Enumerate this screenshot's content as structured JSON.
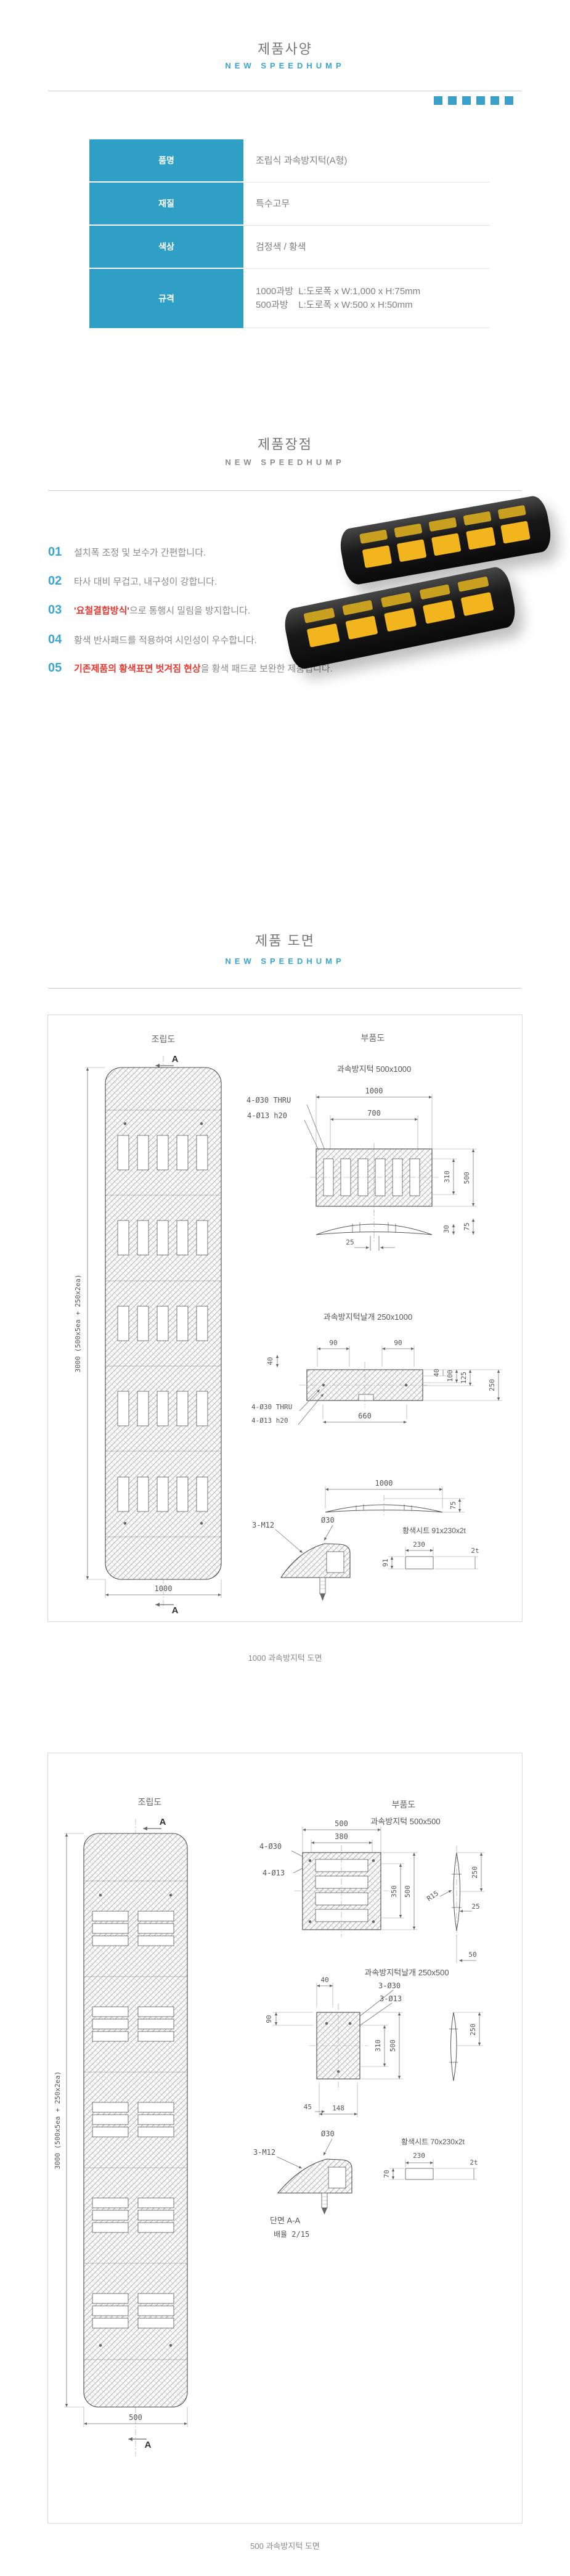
{
  "page": {
    "accent": "#3aa5d2",
    "table_header": "#2f9fc6",
    "red": "#e8372e",
    "pad_yellow": "#f2b51d"
  },
  "sections": {
    "spec": {
      "title": "제품사양",
      "subtitle": "NEW SPEEDHUMP"
    },
    "features": {
      "title": "제품장점",
      "subtitle": "NEW SPEEDHUMP"
    },
    "drawings": {
      "title": "제품 도면",
      "subtitle": "NEW SPEEDHUMP"
    }
  },
  "spec_table": {
    "rows": [
      {
        "label": "품명",
        "value": "조립식 과속방지턱(A형)"
      },
      {
        "label": "재질",
        "value": "특수고무"
      },
      {
        "label": "색상",
        "value": "검정색 / 황색"
      },
      {
        "label": "규격",
        "value_line1": "1000과방  L:도로폭 x W:1,000 x H:75mm",
        "value_line2": "500과방    L:도로폭 x W:500 x H:50mm"
      }
    ]
  },
  "features": {
    "items": [
      {
        "num": "01",
        "red": "",
        "text": "설치폭 조정 및 보수가 간편합니다."
      },
      {
        "num": "02",
        "red": "",
        "text": "타사 대비 무겁고, 내구성이 강합니다."
      },
      {
        "num": "03",
        "red": "'요철결합방식'",
        "text": "으로 통행시 밀림을 방지합니다."
      },
      {
        "num": "04",
        "red": "",
        "text": "황색 반사패드를 적용하여 시인성이 우수합니다."
      },
      {
        "num": "05",
        "red": "기존제품의 황색표면 벗겨짐 현상",
        "text": "을 황색 패드로 보완한 제품입니다."
      }
    ]
  },
  "drawing1": {
    "assembly": "조립도",
    "secA": "A",
    "secA2": "A",
    "left_dim": "3000 (500x5ea + 250x2ea)",
    "bottom_dim": "1000",
    "parts": "부품도",
    "part_title": "과속방지턱 500x1000",
    "d1000": "1000",
    "d700": "700",
    "h30": "4-Ø30 THRU",
    "h13": "4-Ø13 h20",
    "d310": "310",
    "d500": "500",
    "d25": "25",
    "d30": "30",
    "d75": "75",
    "wing_title": "과속방지턱날개 250x1000",
    "w90a": "90",
    "w90b": "90",
    "w40l": "40",
    "w40r": "40",
    "w100": "100",
    "w125": "125",
    "w250": "250",
    "w660": "660",
    "wh30": "4-Ø30 THRU",
    "wh13": "4-Ø13 h20",
    "p1000": "1000",
    "p75": "75",
    "o30": "Ø30",
    "m12": "3-M12",
    "sheet": "황색시트 91x230x2t",
    "s230": "230",
    "s91": "91",
    "s2t": "2t",
    "caption": "1000 과속방지턱 도면"
  },
  "drawing2": {
    "assembly": "조립도",
    "secA": "A",
    "secA2": "A",
    "left_dim": "3000 (500x5ea + 250x2ea)",
    "bottom_dim": "500",
    "parts": "부품도",
    "part_title": "과속방지턱 500x500",
    "d500": "500",
    "d380": "380",
    "h30": "4-Ø30",
    "h13": "4-Ø13",
    "d350": "350",
    "d500b": "500",
    "d250": "250",
    "r15": "R15",
    "d25": "25",
    "d50": "50",
    "wing_title": "과속방지턱날개 250x500",
    "w40": "40",
    "wh30": "3-Ø30",
    "wh13": "3-Ø13",
    "w90": "90",
    "w310": "310",
    "w500": "500",
    "w250": "250",
    "w45": "45",
    "w148": "148",
    "o30": "Ø30",
    "m12": "3-M12",
    "sheet": "황색시트 70x230x2t",
    "s230": "230",
    "s70": "70",
    "s2t": "2t",
    "sec_label": "단면  A-A",
    "scale_label": "배율  2/15",
    "caption": "500 과속방지턱 도면"
  }
}
